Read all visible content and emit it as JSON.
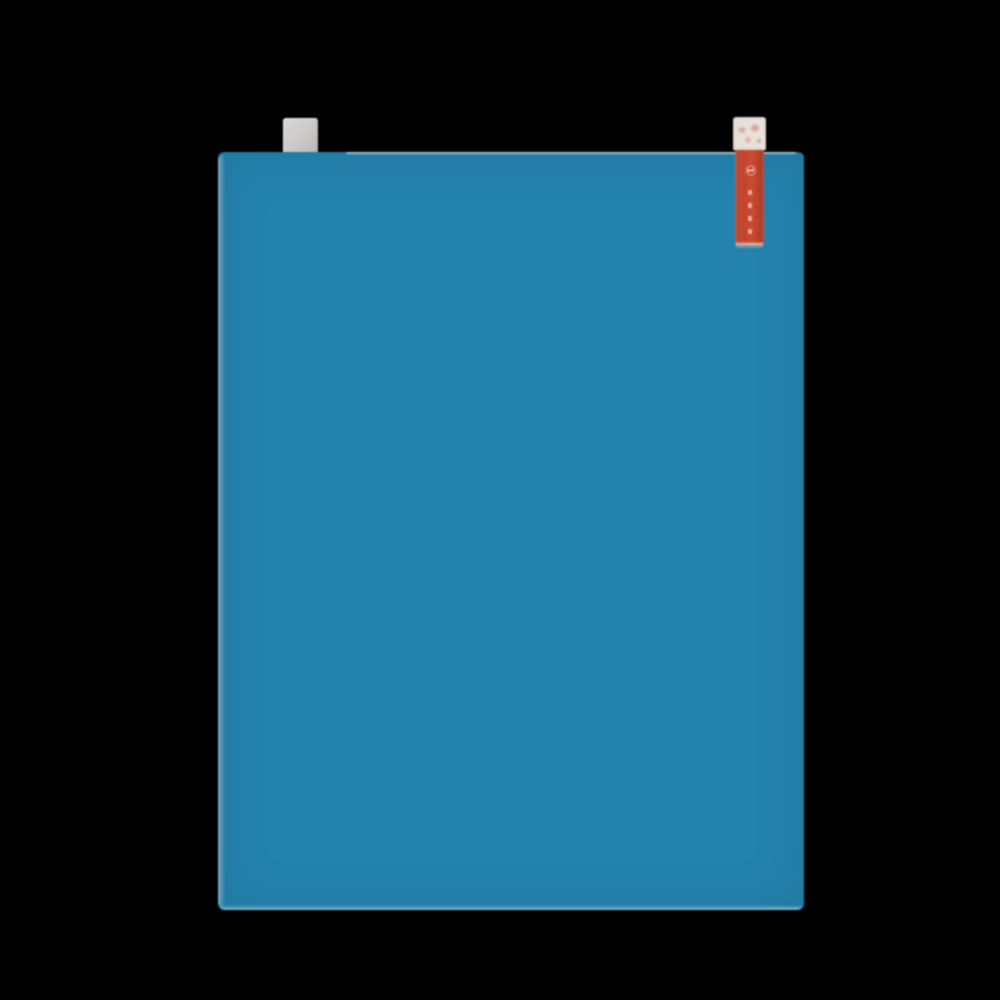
{
  "image": {
    "type": "product-photo",
    "subject": "Blue screen-protector film sheet with peel-off tabs on black background"
  },
  "colors": {
    "background": "#000000",
    "film_blue": "#2483ae",
    "film_edge_light": "#a9d0e0",
    "gray_tab": "#c9c8c6",
    "gray_tab_light": "#dad9d7",
    "red_tab": "#c7432c",
    "red_tab_dark": "#a83a25",
    "red_tab_cap": "#e7e0da"
  },
  "tabs": {
    "red_tab": {
      "glyph": "①"
    }
  }
}
